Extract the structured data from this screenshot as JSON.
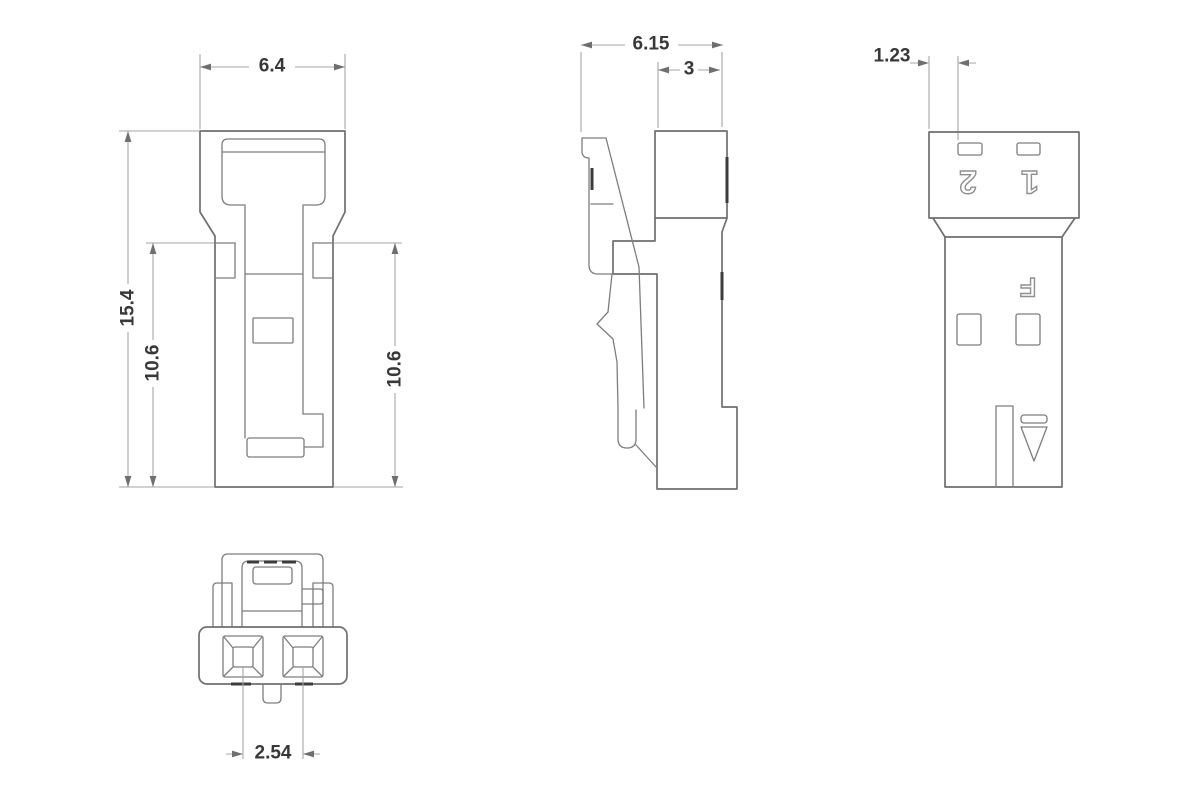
{
  "drawing": {
    "colors": {
      "outline": "#6f6f6f",
      "dimension_line": "#a6a6a6",
      "dimension_text": "#383838",
      "hollow_label_stroke": "#8f8f8f",
      "background": "#ffffff"
    },
    "front_view": {
      "width": "6.4",
      "total_height": "15.4",
      "inner_height_left": "10.6",
      "inner_height_right": "10.6"
    },
    "side_view": {
      "total_depth": "6.15",
      "mating_depth": "3"
    },
    "back_view": {
      "slot_offset": "1.23",
      "pin_2": "2",
      "pin_1": "1",
      "polarity_mark": "F"
    },
    "bottom_view": {
      "pin_pitch": "2.54"
    }
  }
}
